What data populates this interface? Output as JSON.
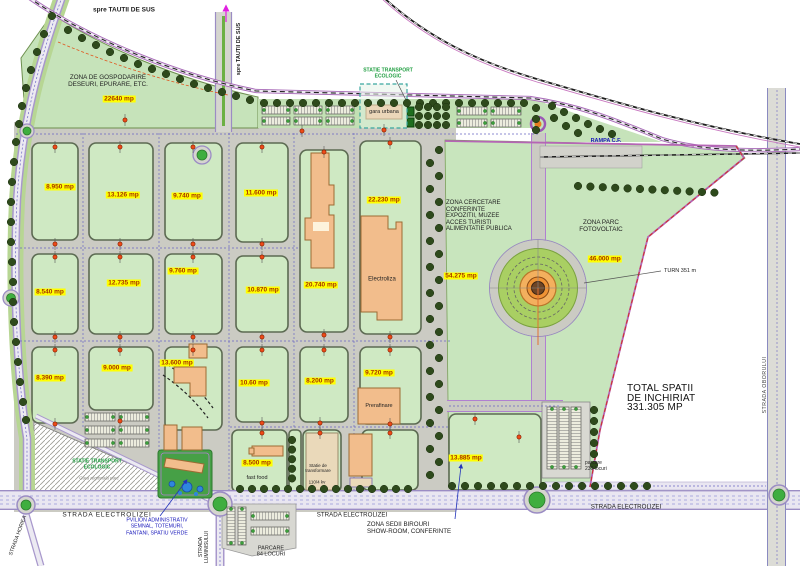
{
  "directions": {
    "tautii": "spre TAUTII DE SUS"
  },
  "zones": {
    "gospodarire": [
      "ZONA DE GOSPODARIRE",
      "DESEURI, EPURARE, ETC."
    ],
    "cercetare": [
      "ZONA CERCETARE",
      "CONFERINTE",
      "EXPOZITII, MUZEE",
      "ACCES TURISTI",
      "ALIMENTATIE PUBLICA"
    ],
    "parc_fotovoltaic": [
      "ZONA PARC",
      "FOTOVOLTAIC"
    ],
    "sedii": [
      "ZONA SEDII BIROURI",
      "SHOW-ROOM, CONFERINTE"
    ],
    "pavilion": [
      "PVILION ADMINISTRATIV",
      "SEMNAL, TOTEMURI,",
      "FANTANI, SPATIU VERDE"
    ]
  },
  "areas": [
    "22640 mp",
    "8.950 mp",
    "13.126 mp",
    "9.740 mp",
    "11.600 mp",
    "22.230 mp",
    "8.540 mp",
    "12.735 mp",
    "9.760 mp",
    "10.870 mp",
    "20.740 mp",
    "8.390 mp",
    "9.000 mp",
    "13.600 mp",
    "10.60 mp",
    "8.200 mp",
    "9.720 mp",
    "54.275 mp",
    "46.000 mp",
    "13.885 mp",
    "8.500 mp"
  ],
  "buildings": {
    "electroliza": "Electroliza",
    "prerafinare": "Prerafinare",
    "gara_urbana": "gara urbana",
    "fast_food": "fast food",
    "statie_transformare": [
      "Statie de",
      "transformare"
    ],
    "statie_kv": "110/4 kv"
  },
  "streets": {
    "electrolizei": "STRADA ELECTROLIZEI",
    "oborului": "STRADA OBORULUI",
    "horiea": "STRADA HORIEA",
    "luminisului": [
      "STRADA",
      "LUMINISULUI"
    ],
    "rampa": "RAMPA C.F."
  },
  "transport": {
    "statie_eco": [
      "STATIE TRANSPORT",
      "ECOLOGIC"
    ],
    "gara_note": "Gara regionala parc"
  },
  "parking": {
    "p84": [
      "PARCARE",
      "84 LOCURI"
    ],
    "p230": [
      "parcare",
      "230 locuri"
    ]
  },
  "summary": {
    "total": [
      "TOTAL SPATII",
      "DE INCHIRIAT",
      "331.305 MP"
    ],
    "turn": "TURN 351 m"
  },
  "colors": {
    "plot_green": "#cfe9c3",
    "highlight_yellow": "#ffff00",
    "area_text": "#a63200",
    "road_purple": "#9b8cc4",
    "rail_black": "#1a1a1a",
    "water_blue": "#2e86de",
    "lawn_green": "#46a046",
    "building_orange": "#f2bd8c"
  }
}
